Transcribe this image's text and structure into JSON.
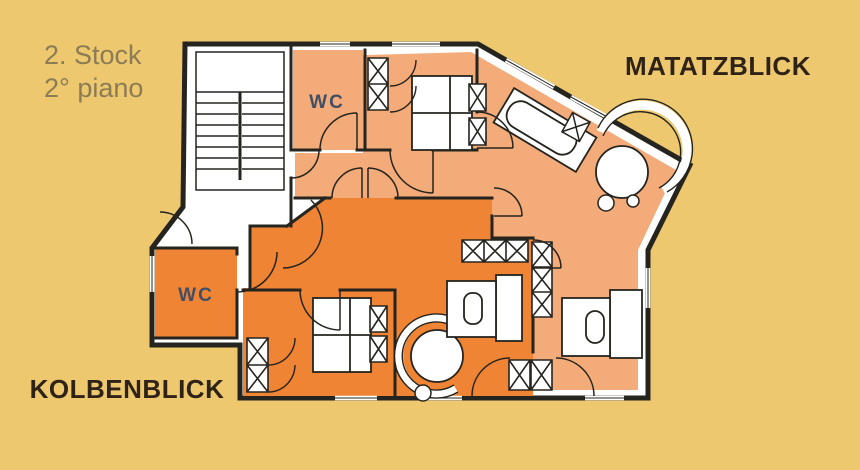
{
  "plan": {
    "floor_label_line1": "2. Stock",
    "floor_label_line2": "2° piano",
    "apartments": [
      {
        "name": "MATATZBLICK",
        "color": "#f3ab79"
      },
      {
        "name": "KOLBENBLICK",
        "color": "#ee8434"
      }
    ],
    "rooms": {
      "wc_upper": "WC",
      "wc_lower": "WC"
    },
    "colors": {
      "background": "#edc86e",
      "wall": "#26241f",
      "wc_text": "#414f66",
      "floor_text": "#8b7c55",
      "name_text": "#2f2318"
    }
  }
}
